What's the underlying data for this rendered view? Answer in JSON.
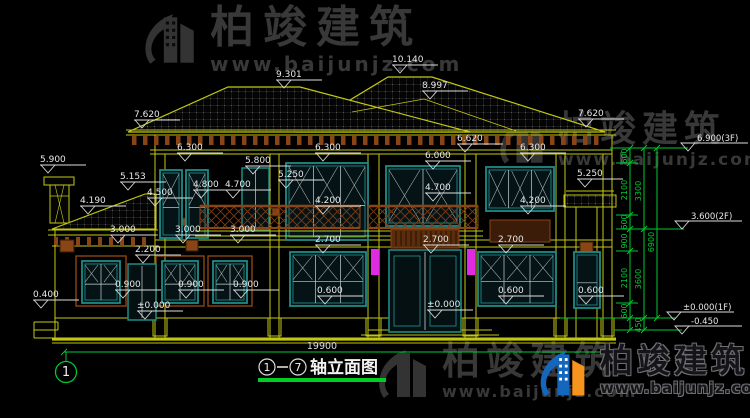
{
  "title": {
    "full": "①-⑦轴立面图",
    "axis_from": "1",
    "axis_to": "7",
    "name": "轴立面图"
  },
  "overall_dimension": "19900",
  "axis_bubbles": [
    "1"
  ],
  "watermarks": {
    "top_left": {
      "brand": "柏竣建筑",
      "url": "www.baijunjz.com"
    },
    "mid_right": {
      "brand": "柏竣建筑",
      "url": "www.baijunjz.com"
    },
    "bottom_center": {
      "brand": "柏竣建筑",
      "url": "www.baijunjz.com"
    },
    "bottom_right": {
      "brand": "柏竣建筑",
      "url": "www.baijunjz.com"
    }
  },
  "colors": {
    "bg": "#000000",
    "line_yellow": "#c3c714",
    "teal": "#1f8a86",
    "glass_line": "#c8d4d4",
    "brown": "#8a4516",
    "brown_dark": "#5c2d0c",
    "green": "#00c832",
    "green_bright": "#00cc22",
    "white": "#e8e8e8",
    "magenta": "#e02ce0",
    "watermark_gray": "#383838",
    "logo_blue": "#1566bd",
    "logo_orange": "#f7941d"
  },
  "elevation_labels": [
    {
      "text": "10.140",
      "x": 400,
      "y": 62
    },
    {
      "text": "9.301",
      "x": 284,
      "y": 77
    },
    {
      "text": "8.997",
      "x": 430,
      "y": 88
    },
    {
      "text": "7.620",
      "x": 142,
      "y": 117
    },
    {
      "text": "7.620",
      "x": 586,
      "y": 116
    },
    {
      "text": "6.620",
      "x": 465,
      "y": 141
    },
    {
      "text": "6.300",
      "x": 185,
      "y": 150
    },
    {
      "text": "6.300",
      "x": 323,
      "y": 150
    },
    {
      "text": "6.300",
      "x": 528,
      "y": 150
    },
    {
      "text": "6.000",
      "x": 433,
      "y": 158
    },
    {
      "text": "5.900",
      "x": 48,
      "y": 162
    },
    {
      "text": "5.800",
      "x": 253,
      "y": 163
    },
    {
      "text": "5.250",
      "x": 286,
      "y": 177
    },
    {
      "text": "5.250",
      "x": 585,
      "y": 176
    },
    {
      "text": "5.153",
      "x": 128,
      "y": 179
    },
    {
      "text": "4.800",
      "x": 201,
      "y": 187
    },
    {
      "text": "4.700",
      "x": 233,
      "y": 187
    },
    {
      "text": "4.700",
      "x": 433,
      "y": 190
    },
    {
      "text": "4.500",
      "x": 155,
      "y": 195
    },
    {
      "text": "4.200",
      "x": 323,
      "y": 203
    },
    {
      "text": "4.200",
      "x": 528,
      "y": 203
    },
    {
      "text": "4.190",
      "x": 88,
      "y": 203
    },
    {
      "text": "3.000",
      "x": 118,
      "y": 232
    },
    {
      "text": "3.000",
      "x": 183,
      "y": 232
    },
    {
      "text": "3.000",
      "x": 238,
      "y": 232
    },
    {
      "text": "2.700",
      "x": 323,
      "y": 242
    },
    {
      "text": "2.700",
      "x": 431,
      "y": 242
    },
    {
      "text": "2.700",
      "x": 506,
      "y": 242
    },
    {
      "text": "2.200",
      "x": 143,
      "y": 252
    },
    {
      "text": "0.900",
      "x": 123,
      "y": 287
    },
    {
      "text": "0.900",
      "x": 186,
      "y": 287
    },
    {
      "text": "0.900",
      "x": 241,
      "y": 287
    },
    {
      "text": "0.600",
      "x": 325,
      "y": 293
    },
    {
      "text": "0.600",
      "x": 506,
      "y": 293
    },
    {
      "text": "0.600",
      "x": 586,
      "y": 293
    },
    {
      "text": "0.400",
      "x": 41,
      "y": 297
    },
    {
      "text": "±0.000",
      "x": 145,
      "y": 308
    },
    {
      "text": "±0.000",
      "x": 435,
      "y": 307
    }
  ],
  "level_flags": [
    {
      "text": "6.900(3F)",
      "x": 688,
      "y": 140
    },
    {
      "text": "3.600(2F)",
      "x": 682,
      "y": 218
    },
    {
      "text": "±0.000(1F)",
      "x": 674,
      "y": 309
    },
    {
      "text": "-0.450",
      "x": 682,
      "y": 323
    }
  ],
  "dim_chain": {
    "segments": [
      "600",
      "2100",
      "600",
      "900",
      "2100",
      "600",
      "450"
    ],
    "subtotals": [
      "3300",
      "3600"
    ],
    "total": "6900",
    "labels": [
      {
        "text": "600",
        "x": 627,
        "y": 156
      },
      {
        "text": "2100",
        "x": 627,
        "y": 190
      },
      {
        "text": "600",
        "x": 627,
        "y": 222
      },
      {
        "text": "900",
        "x": 627,
        "y": 241
      },
      {
        "text": "2100",
        "x": 627,
        "y": 278
      },
      {
        "text": "600",
        "x": 627,
        "y": 311
      },
      {
        "text": "450",
        "x": 641,
        "y": 325
      },
      {
        "text": "3300",
        "x": 641,
        "y": 191
      },
      {
        "text": "3600",
        "x": 641,
        "y": 279
      },
      {
        "text": "6900",
        "x": 654,
        "y": 242
      }
    ]
  }
}
